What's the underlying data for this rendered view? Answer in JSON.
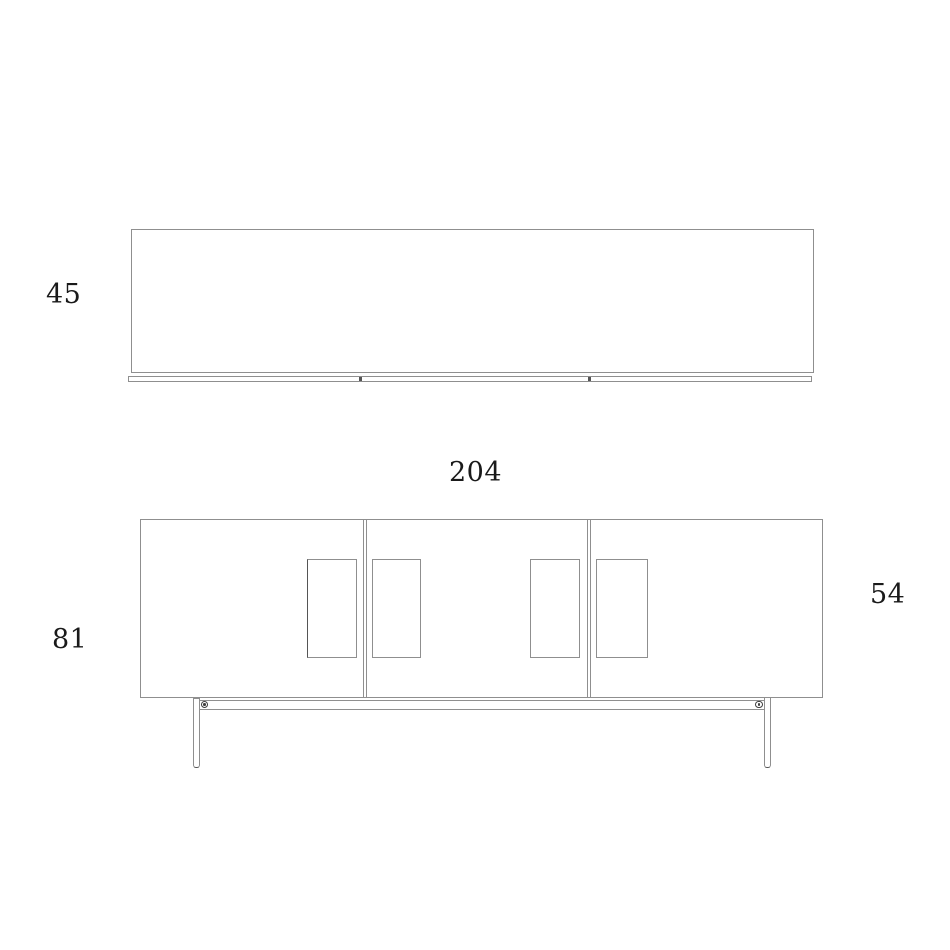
{
  "views": {
    "plan_view": {
      "labels": {
        "depth": "45"
      }
    },
    "front_view": {
      "labels": {
        "width": "204",
        "overall_height": "81",
        "carcass_height": "54"
      }
    }
  },
  "colors": {
    "background": "#ffffff",
    "outline": "#8f8f8f",
    "outline_dark": "#555555",
    "text": "#1a1a1a"
  }
}
